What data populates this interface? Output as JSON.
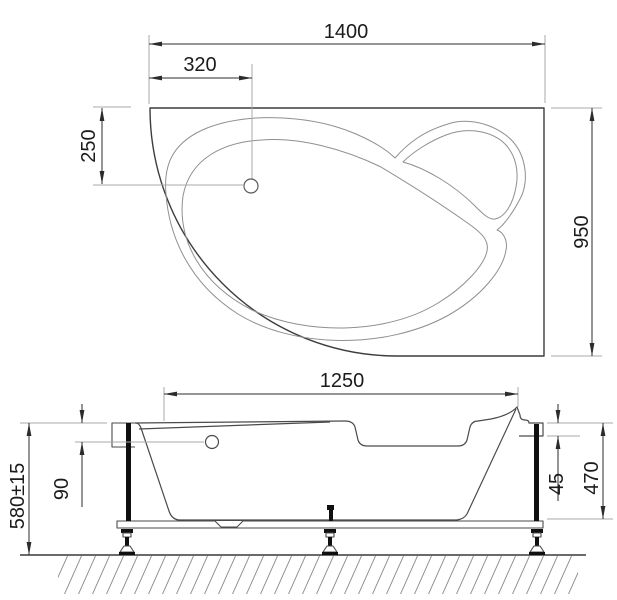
{
  "drawing": {
    "background": "#ffffff",
    "line_color": "#2b2b2b",
    "labels": {
      "top_width": "1400",
      "drain_offset": "320",
      "drain_depth": "250",
      "overall_depth": "950",
      "side_length": "1250",
      "overflow_height": "90",
      "total_height": "580±15",
      "rim_thickness": "45",
      "panel_height": "470"
    }
  }
}
